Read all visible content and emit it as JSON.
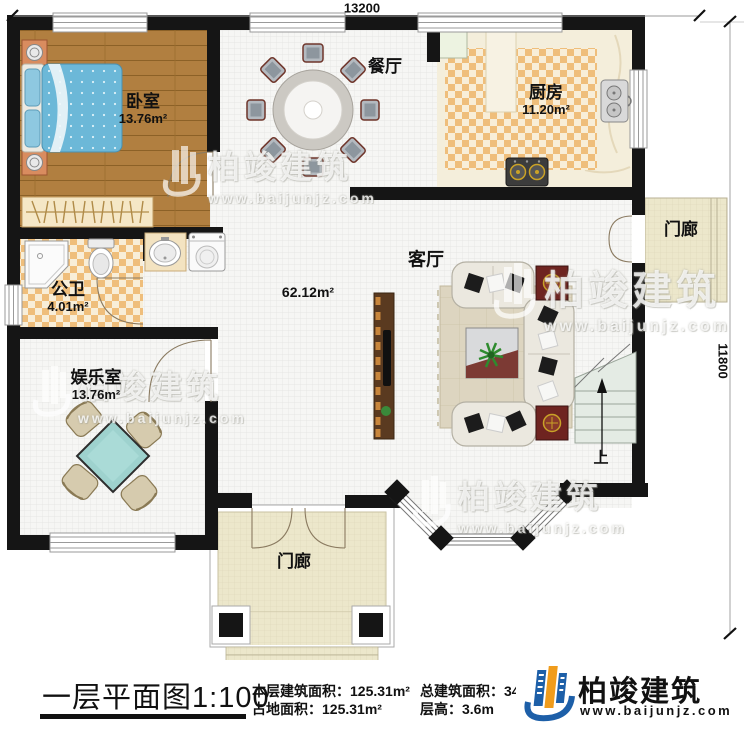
{
  "dimensions": {
    "width_label": "13200",
    "height_label": "11800"
  },
  "rooms": {
    "bedroom": {
      "name": "卧室",
      "area": "13.76m²"
    },
    "dining": {
      "name": "餐厅"
    },
    "kitchen": {
      "name": "厨房",
      "area": "11.20m²"
    },
    "bathroom": {
      "name": "公卫",
      "area": "4.01m²"
    },
    "entertainment": {
      "name": "娱乐室",
      "area": "13.76m²"
    },
    "living": {
      "name": "客厅",
      "area": "62.12m²"
    },
    "porch_right": {
      "name": "门廊"
    },
    "porch_bottom": {
      "name": "门廊"
    },
    "stairs": {
      "direction_label": "上"
    }
  },
  "titleblock": {
    "title": "一层平面图",
    "scale": "1:100",
    "stats": [
      {
        "label": "本层建筑面积：",
        "value": "125.31m²"
      },
      {
        "label": "总建筑面积：",
        "value": "342.62m²"
      },
      {
        "label": "占地面积：",
        "value": "125.31m²"
      },
      {
        "label": "层高：",
        "value": "3.6m"
      }
    ]
  },
  "brand": {
    "name": "柏竣建筑",
    "url": "www.baijunjz.com"
  },
  "watermark": {
    "name": "柏竣建筑",
    "url": "www.baijunjz.com"
  },
  "colors": {
    "wall": "#151515",
    "wood": "#b17f40",
    "checker": "#efbe7b",
    "porch_tile": "#ece7cb",
    "brand_blue": "#1d5fa8",
    "brand_orange": "#f09c1c",
    "table_teal": "#9ed2ce",
    "bed_blue": "#6cb8d8"
  }
}
